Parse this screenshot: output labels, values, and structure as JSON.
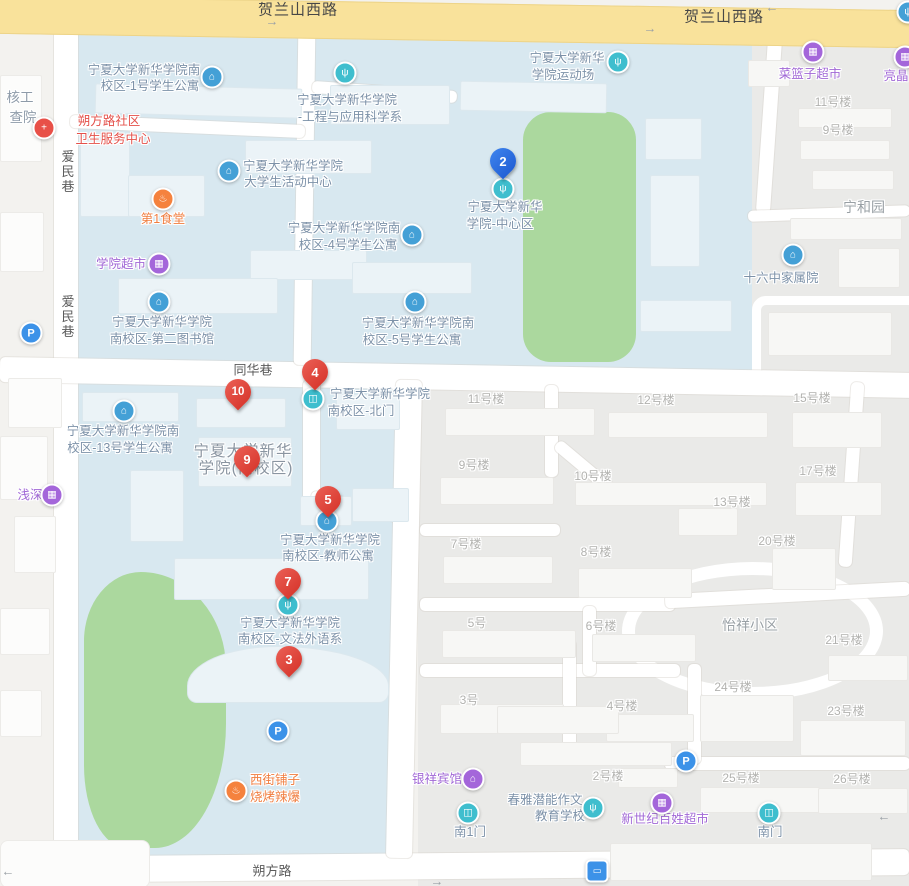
{
  "map_title": "宁夏大学新华学院(南校区) 地图",
  "colors": {
    "road_primary": "#F9E29B",
    "campus_area": "#D8E8F0",
    "residential_area": "#EAEAE8",
    "green_area": "#ABD89E",
    "marker_red": "#DD4238",
    "marker_blue": "#2C70E4",
    "poi_blue_icon": "#44A0D6",
    "poi_teal_icon": "#3FBECE",
    "poi_purple": "#A466DA",
    "poi_orange": "#F5823E",
    "poi_red": "#E85048",
    "parking_blue": "#3C92E8",
    "campus_label_text": "#7C91A8",
    "building_label_text": "#B2B2AF",
    "road_label_text": "#5B5B5B"
  },
  "glyphs": {
    "building": "⌂",
    "education": "ψ",
    "gate": "◫",
    "shop": "▦",
    "food": "♨",
    "hospital": "+",
    "hotel": "⌂",
    "parking": "P",
    "bus": "▭",
    "arrow_left": "←",
    "arrow_right": "→"
  },
  "roads": {
    "helanshan_west_1": "贺兰山西路",
    "helanshan_west_2": "贺兰山西路",
    "aimin_lane_1": "爱民巷",
    "aimin_lane_2": "爱民巷",
    "tonghua_lane": "同华巷",
    "shuofang_road": "朔方路"
  },
  "areas": {
    "ninghe_garden": "宁和园",
    "yixiang_estate": "怡祥小区",
    "campus_name_line1": "宁夏大学新华",
    "campus_name_line2": "学院(南校区)",
    "clipped_left_line1": "核工",
    "clipped_left_line2": "查院"
  },
  "pois": {
    "apt1": {
      "l1": "宁夏大学新华学院南",
      "l2": "校区-1号学生公寓"
    },
    "engineering": {
      "l1": "宁夏大学新华学院",
      "l2": "-工程与应用科学系"
    },
    "activity_center": {
      "l1": "宁夏大学新华学院",
      "l2": "大学生活动中心"
    },
    "health_center": {
      "l1": "朔方路社区",
      "l2": "卫生服务中心"
    },
    "canteen1": {
      "l1": "第1食堂"
    },
    "college_market": {
      "l1": "学院超市"
    },
    "library2": {
      "l1": "宁夏大学新华学院",
      "l2": "南校区-第二图书馆"
    },
    "apt4": {
      "l1": "宁夏大学新华学院南",
      "l2": "校区-4号学生公寓"
    },
    "apt5": {
      "l1": "宁夏大学新华学院南",
      "l2": "校区-5号学生公寓"
    },
    "stadium": {
      "l1": "宁夏大学新华",
      "l2": "学院运动场"
    },
    "center_zone": {
      "l1": "宁夏大学新华",
      "l2": "学院-中心区"
    },
    "cailanzi": {
      "l1": "菜篮子超市"
    },
    "liangjing": {
      "l1": "亮晶"
    },
    "shiliuzhong": {
      "l1": "十六中家属院"
    },
    "qianshen": {
      "l1": "浅深"
    },
    "apt13": {
      "l1": "宁夏大学新华学院南",
      "l2": "校区-13号学生公寓"
    },
    "north_gate": {
      "l1": "宁夏大学新华学院",
      "l2": "南校区-北门"
    },
    "teacher_apt": {
      "l1": "宁夏大学新华学院",
      "l2": "南校区-教师公寓"
    },
    "liberal_arts": {
      "l1": "宁夏大学新华学院",
      "l2": "南校区-文法外语系"
    },
    "xijie": {
      "l1": "西街铺子",
      "l2": "烧烤辣爆"
    },
    "yinxiang_hotel": {
      "l1": "银祥宾馆"
    },
    "chunya": {
      "l1": "春雅潜能作文",
      "l2": "教育学校"
    },
    "south_gate1": {
      "l1": "南1门"
    },
    "xinshiji": {
      "l1": "新世纪百姓超市"
    },
    "south_gate": {
      "l1": "南门"
    }
  },
  "building_labels": {
    "tr_11": "11号楼",
    "tr_9": "9号楼",
    "b11": "11号楼",
    "b12": "12号楼",
    "b15": "15号楼",
    "b9": "9号楼",
    "b10": "10号楼",
    "b17": "17号楼",
    "b13": "13号楼",
    "b7": "7号楼",
    "b8": "8号楼",
    "b20": "20号楼",
    "b5": "5号",
    "b6": "6号楼",
    "b21": "21号楼",
    "b3": "3号",
    "b4": "4号楼",
    "b24": "24号楼",
    "b23": "23号楼",
    "b2": "2号楼",
    "b25": "25号楼",
    "b26": "26号楼"
  },
  "markers": {
    "m2": "2",
    "m3": "3",
    "m4": "4",
    "m5": "5",
    "m7": "7",
    "m9": "9",
    "m10": "10"
  }
}
